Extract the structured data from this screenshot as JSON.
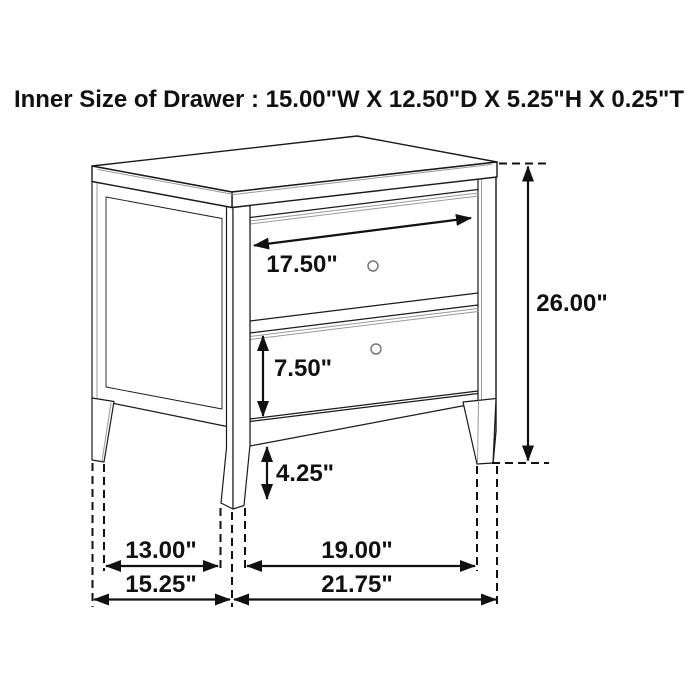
{
  "title": "Inner Size of Drawer : 15.00\"W X 12.50\"D X 5.25\"H X 0.25\"T",
  "dimensions": {
    "top_drawer_width": "17.50\"",
    "bottom_drawer_height": "7.50\"",
    "leg_height": "4.25\"",
    "overall_height": "26.00\"",
    "legs_inner_depth": "13.00\"",
    "legs_inner_width": "19.00\"",
    "overall_depth": "15.25\"",
    "overall_width": "21.75\""
  }
}
